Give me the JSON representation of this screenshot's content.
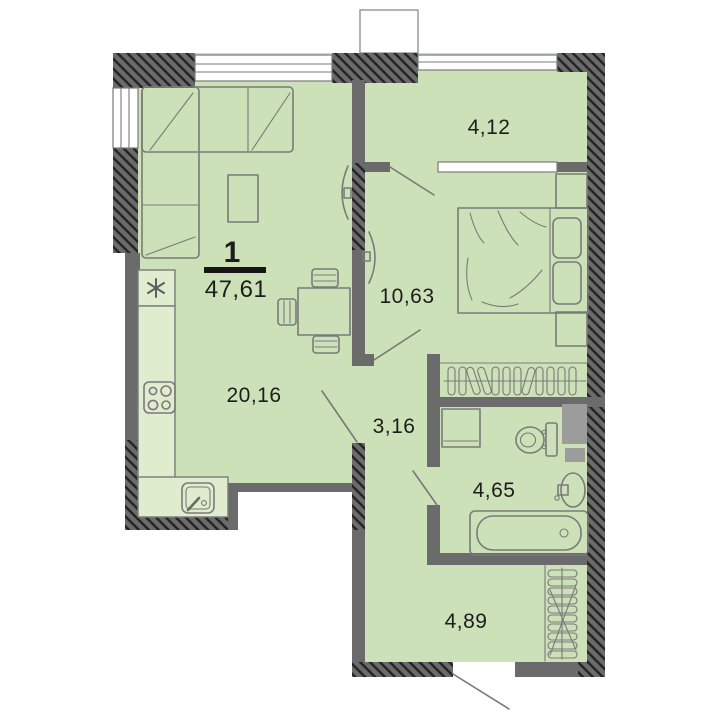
{
  "floor_plan": {
    "rooms_count_label": "1",
    "total_area": "47,61",
    "rooms": [
      {
        "id": "balcony",
        "area": "4,12"
      },
      {
        "id": "bedroom",
        "area": "10,63"
      },
      {
        "id": "living-kitchen",
        "area": "20,16"
      },
      {
        "id": "corridor",
        "area": "3,16"
      },
      {
        "id": "bathroom",
        "area": "4,65"
      },
      {
        "id": "hallway",
        "area": "4,89"
      }
    ],
    "colors": {
      "floor": "#cde1b9",
      "counter": "#dfeccd",
      "wall": "#6b6b6b",
      "hatch": "#222222",
      "outline": "#7a7a7a",
      "shaft": "#9c9c9c",
      "text": "#1d1d1d"
    }
  }
}
